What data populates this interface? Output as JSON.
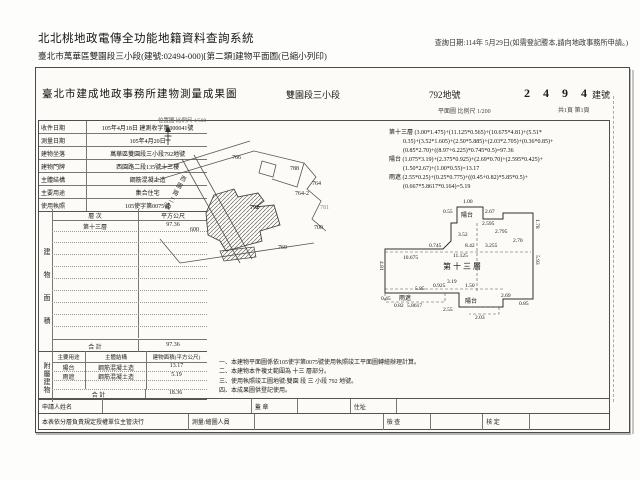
{
  "header": {
    "system_title": "北北桃地政電傳全功能地籍資料查詢系統",
    "query_date": "查詢日期:114年 5月29日(如需登記謄本,請向地政事務所申請。)",
    "subtitle": "臺北市萬華區雙園段三小段(建號:02494-000)[第二類]建物平面圖(已縮小列印)"
  },
  "form": {
    "office_title": "臺北市建成地政事務所建物測量成果圖",
    "section": "雙園段三小段",
    "land_no": "792地號",
    "building_no": "2 4 9 4",
    "building_no_label": "建號",
    "scale_note": "平面圖 比例尺 1/200",
    "page_note": "共1頁 第1頁",
    "info_rows": [
      {
        "label": "收件日期",
        "value": "105年4月18日 建測收字第000041號"
      },
      {
        "label": "測量日期",
        "value": "105年4月20日"
      },
      {
        "label": "建物坐落",
        "value": "萬華區雙園段三小段792地號"
      },
      {
        "label": "建物門牌",
        "value": "西園路二段135號十三樓"
      },
      {
        "label": "主體結構",
        "value": "鋼筋混凝土造"
      },
      {
        "label": "主要用途",
        "value": "集合住宅"
      },
      {
        "label": "使用執照",
        "value": "105使字第0075號"
      }
    ],
    "area_table": {
      "vertical_label": "建物面積",
      "col_floor": "層 次",
      "col_area": "平方公尺",
      "rows": [
        {
          "floor": "第十三層",
          "area": "97.36"
        }
      ],
      "total_label": "合 計",
      "total": "97.36"
    },
    "annex_table": {
      "vertical_label": "附屬建物",
      "col_use": "主要用途",
      "col_structure": "主體結構",
      "col_area": "建物面積(平方公尺)",
      "rows": [
        {
          "use": "陽台",
          "structure": "鋼筋混凝土造",
          "area": "13.17"
        },
        {
          "use": "雨遮",
          "structure": "鋼筋混凝土造",
          "area": "5.19"
        }
      ],
      "total_label": "合 計",
      "total": "18.36"
    },
    "notes": [
      "一、本建物平面圖係依105使字第0075號使用執照竣工平面圖轉繪辦理計算。",
      "二、本建物本件複丈範圍為 十三 層部分。",
      "三、使用執照竣工圖地號:雙園 段 三 小段 792 地號。",
      "四、本成果圖供登記使用。"
    ],
    "signoff": {
      "applicant_label": "申請人姓名",
      "seal_label": "蓋 章",
      "address_label": "住址",
      "delegation_note": "本表依分層負責規定授權單位主管決行",
      "surveyor_label": "測量/繪圖人員",
      "check_label": "檢 查",
      "approve_label": "核 定"
    }
  },
  "site_map": {
    "caption": "位置圖 比例尺 1/500",
    "road_name": "西園路二段",
    "subject_lot": "792",
    "lots": [
      {
        "no": "766"
      },
      {
        "no": "788"
      },
      {
        "no": "764"
      },
      {
        "no": "764-2"
      },
      {
        "no": "781"
      },
      {
        "no": "700"
      },
      {
        "no": "769"
      },
      {
        "no": "600"
      }
    ]
  },
  "floor_plan": {
    "room_label": "第十三層",
    "balcony_top_label": "陽台",
    "balcony_bottom_label": "陽台",
    "canopy_label": "雨遮",
    "formula_lines": [
      "第十三層 (3.00*1.475)+(11.125*0.565)+(10.675*4.81)+(5.51*",
      "0.35)+(3.52*1.605)+(2.50*5.885)+(2.03*2.705)+(0.36*0.85)+",
      "(0.85*2.70)+((8.97+6.225)*0.745*0.5)=97.36",
      "陽台 (1.075*3.19)+(2.375*0.925)+(2.69*0.70)+(2.595*0.425)+",
      "(1.50*2.67)+(1.00*0.55)=13.17",
      "雨遮 (2.55*0.25)+(0.25*0.775)+((0.45+0.82)*5.85*0.5)+",
      "(0.667*5.8617*0.164)=5.19"
    ],
    "dims": [
      "1.00",
      "0.55",
      "2.67",
      "2.595",
      "3.52",
      "2.795",
      "2.70",
      "1.78",
      "8.42",
      "3.255",
      "0.745",
      "11.125",
      "10.675",
      "4.81",
      "5.93",
      "3.19",
      "1.50",
      "0.925",
      "5.85",
      "5.8617",
      "0.45",
      "0.82",
      "2.69",
      "2.55",
      "2.03",
      "0.85"
    ]
  }
}
